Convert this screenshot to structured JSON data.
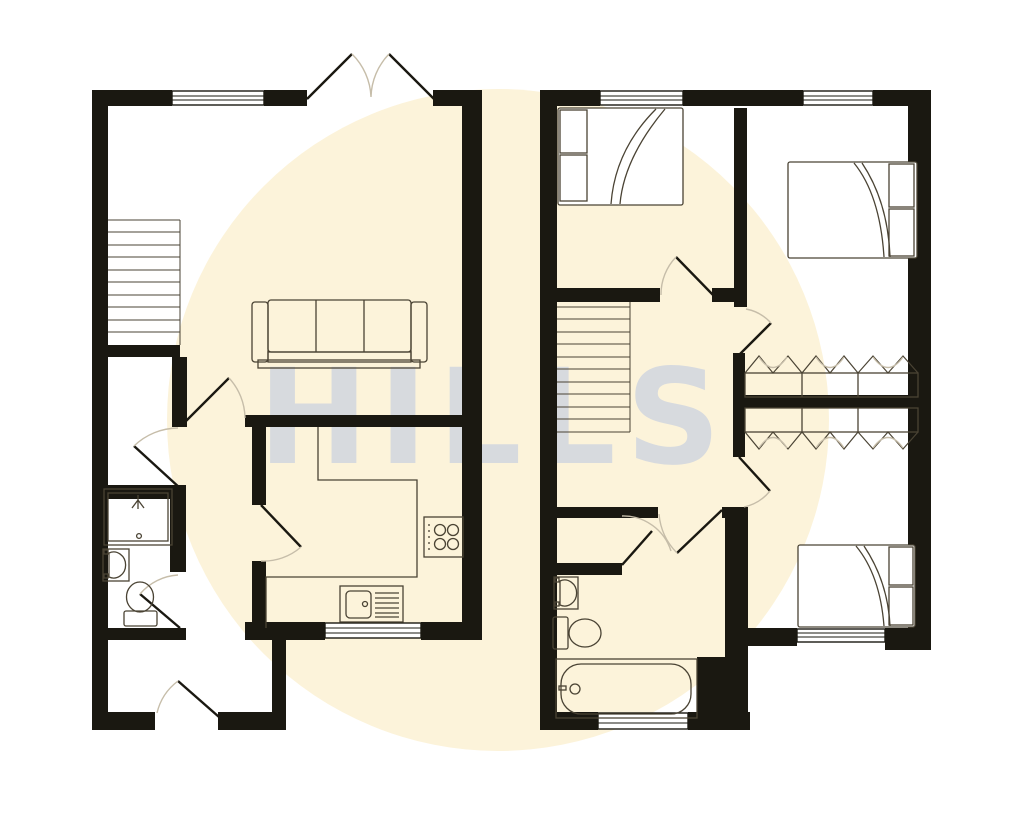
{
  "watermark": {
    "text": "HILLS"
  },
  "palette": {
    "background": "#ffffff",
    "highlight": "#fcf3da",
    "wall": "#1a1811",
    "furniture_line": "#4a4334",
    "door_arc": "#c6bda9",
    "watermark_color": "#b9c6e2"
  },
  "floorplan": {
    "type": "two-unit floor plan (ground floor left dwelling, first floor right dwelling)",
    "left_unit_elements": [
      "staircase",
      "sofa",
      "kitchen-counter",
      "hob",
      "sink-with-drainer",
      "shower-enclosure",
      "wash-basin",
      "toilet",
      "french-doors",
      "entrance-door"
    ],
    "right_unit_elements": [
      "staircase",
      "double-bed",
      "double-bed",
      "single-bed",
      "built-in-wardrobes",
      "wash-basin",
      "toilet",
      "bathtub"
    ],
    "window_count": 7,
    "door_swing_count": 11
  }
}
